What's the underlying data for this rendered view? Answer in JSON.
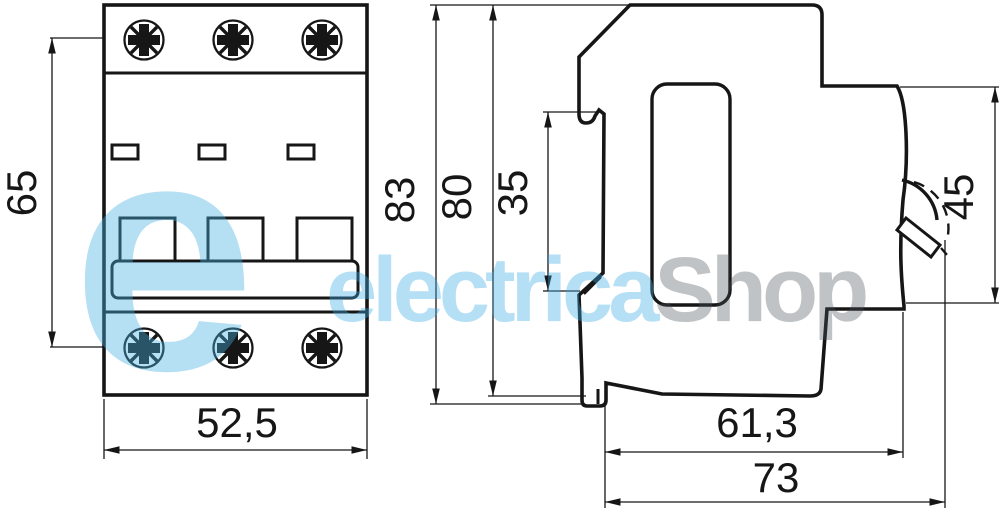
{
  "watermark": {
    "logo_letter": "e",
    "brand_primary": "electrica",
    "brand_secondary": "Shop",
    "brand_blue": "#3aaae1",
    "brand_gray": "#4b525a"
  },
  "drawing": {
    "ink_color": "#161616",
    "background": "#ffffff",
    "views": {
      "front": {
        "name": "front-view",
        "dims": {
          "height": "65",
          "width": "52,5"
        }
      },
      "side": {
        "name": "side-view",
        "dims": {
          "total_height": "83",
          "body_height": "80",
          "din_rail_height": "35",
          "front_face_height": "45",
          "body_depth": "61,3",
          "total_depth": "73"
        }
      }
    }
  }
}
